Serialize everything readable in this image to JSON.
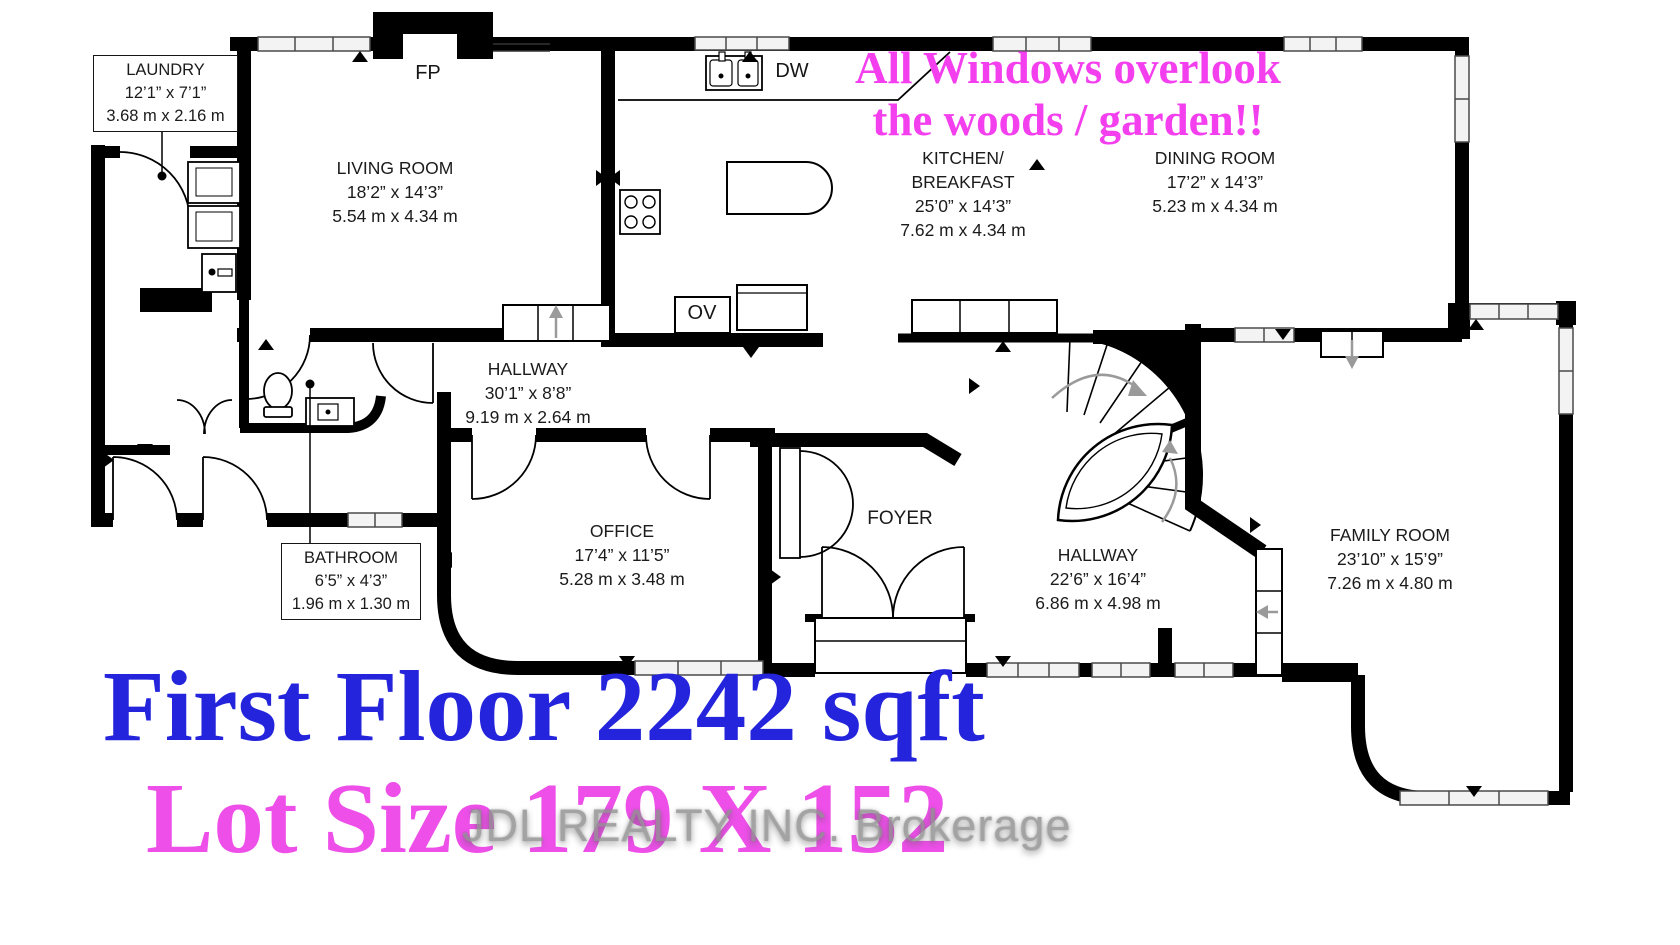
{
  "annotation": {
    "line1": "All Windows overlook",
    "line2": "the woods / garden!!"
  },
  "rooms": {
    "laundry": {
      "name": "LAUNDRY",
      "imperial": "12’1” x 7’1”",
      "metric": "3.68 m x 2.16 m"
    },
    "living": {
      "name": "LIVING ROOM",
      "imperial": "18’2” x 14’3”",
      "metric": "5.54 m x 4.34 m"
    },
    "kitchen": {
      "name_line1": "KITCHEN/",
      "name_line2": "BREAKFAST",
      "imperial": "25’0” x 14’3”",
      "metric": "7.62 m x 4.34 m"
    },
    "dining": {
      "name": "DINING ROOM",
      "imperial": "17’2” x 14’3”",
      "metric": "5.23 m x 4.34 m"
    },
    "hallway_main": {
      "name": "HALLWAY",
      "imperial": "30’1” x 8’8”",
      "metric": "9.19 m x 2.64 m"
    },
    "bathroom": {
      "name": "BATHROOM",
      "imperial": "6’5” x 4’3”",
      "metric": "1.96 m x 1.30 m"
    },
    "office": {
      "name": "OFFICE",
      "imperial": "17’4” x 11’5”",
      "metric": "5.28 m x 3.48 m"
    },
    "foyer": {
      "name": "FOYER"
    },
    "hallway_rear": {
      "name": "HALLWAY",
      "imperial": "22’6” x 16’4”",
      "metric": "6.86 m x 4.98 m"
    },
    "family": {
      "name": "FAMILY ROOM",
      "imperial": "23’10” x 15’9”",
      "metric": "7.26 m x 4.80 m"
    }
  },
  "fixture_labels": {
    "fireplace": "FP",
    "dishwasher": "DW",
    "oven": "OV"
  },
  "footer": {
    "area": "First Floor 2242 sqft",
    "lot": "Lot Size 179 X 152",
    "watermark": "JDL REALTY INC. Brokerage"
  },
  "colors": {
    "annotation_pink": "#f33fee",
    "area_blue": "#2424dc",
    "lot_pink": "#ee4fe9",
    "watermark_gray": "#8f8f8f",
    "wall_black": "#000000"
  }
}
